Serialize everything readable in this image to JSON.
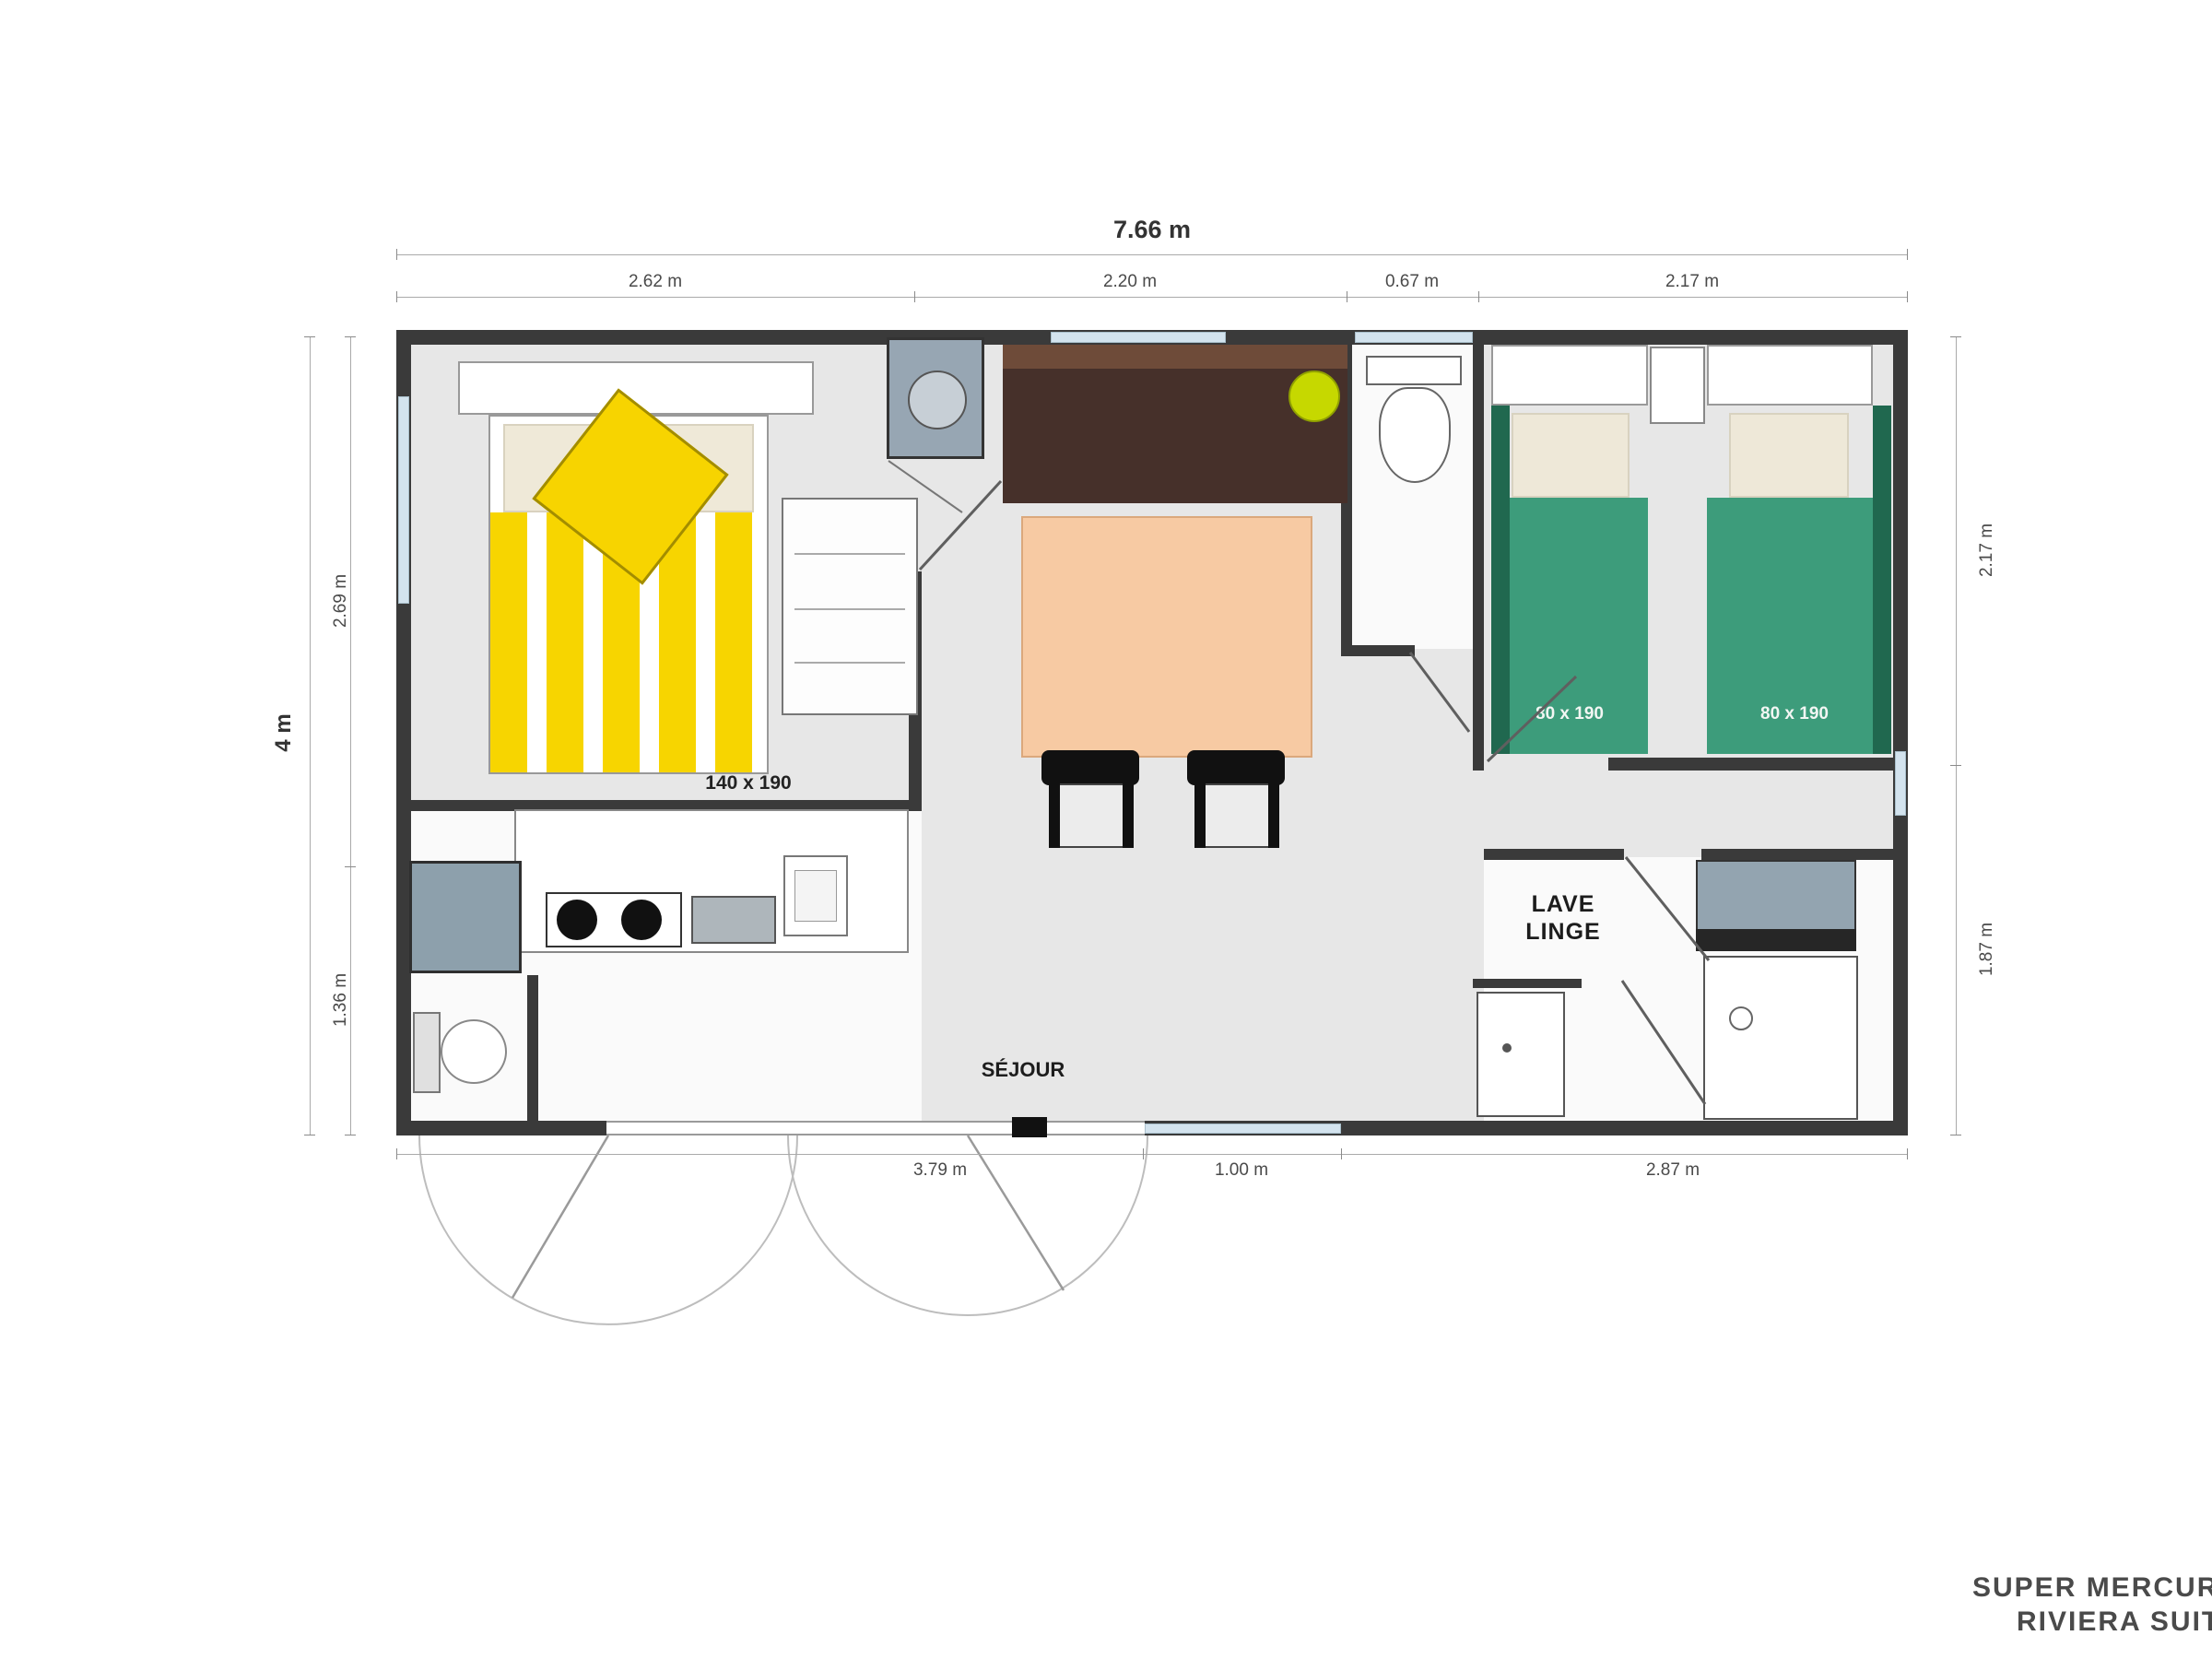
{
  "plan": {
    "brand_line1": "SUPER MERCURE",
    "brand_line2": "RIVIERA SUITE"
  },
  "dimensions": {
    "total_width": "7.66 m",
    "total_height": "4 m",
    "top_segments": [
      "2.62 m",
      "2.20 m",
      "0.67 m",
      "2.17 m"
    ],
    "left_segments": [
      "2.69 m",
      "1.36 m"
    ],
    "right_segments": [
      "2.17 m",
      "1.87 m"
    ],
    "bottom_segments": [
      "3.79 m",
      "1.00 m",
      "2.87 m"
    ]
  },
  "rooms": {
    "living_label": "SÉJOUR",
    "master_bed_label": "140 x 190",
    "twin_bed1_label": "80 x 190",
    "twin_bed2_label": "80 x 190",
    "washer_line1": "LAVE",
    "washer_line2": "LINGE"
  },
  "colors": {
    "wall": "#3a3a3a",
    "floor_gray": "#e7e7e7",
    "window_blue": "#d3e3ee",
    "bed_yellow": "#f7d500",
    "bed_green": "#3d9c7b",
    "bed_green_dark": "#20684f",
    "bench_brown": "#46302a",
    "bench_brown_light": "#6e4b39",
    "cushion_lime": "#c6d800",
    "table_peach": "#f7caa3",
    "appliance_gray": "#8da0ac",
    "pillow_cream": "#efe9d8"
  }
}
